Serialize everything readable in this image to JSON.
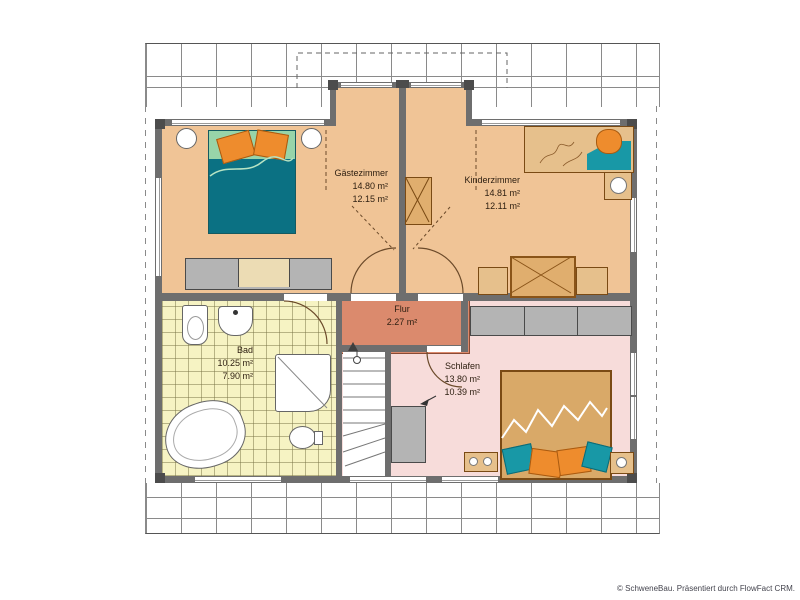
{
  "rooms": {
    "gaestezimmer": {
      "label": "Gästezimmer",
      "area_total": "14.80 m²",
      "area_living": "12.15 m²"
    },
    "kinderzimmer": {
      "label": "Kinderzimmer",
      "area_total": "14.81 m²",
      "area_living": "12.11 m²"
    },
    "flur": {
      "label": "Flur",
      "area_total": "2.27 m²"
    },
    "bad": {
      "label": "Bad",
      "area_total": "10.25 m²",
      "area_living": "7.90 m²"
    },
    "schlafen": {
      "label": "Schlafen",
      "area_total": "13.80 m²",
      "area_living": "10.39 m²"
    }
  },
  "footer": {
    "copyright": "© SchweneBau. Präsentiert durch FlowFact CRM."
  },
  "colors": {
    "room_floor": "#f0c496",
    "hall_floor": "#db8a6d",
    "bath_floor": "#f6f3c3",
    "bedroom_floor": "#f7dcda",
    "wall": "#6e6e6e",
    "bed_blanket_teal": "#0b7183",
    "bed_top_green": "#98d4a9",
    "pillow_orange": "#ee8c2d",
    "wood": "#d9a968",
    "textile_teal": "#1898a6",
    "furniture_gray": "#b4b4b4"
  }
}
